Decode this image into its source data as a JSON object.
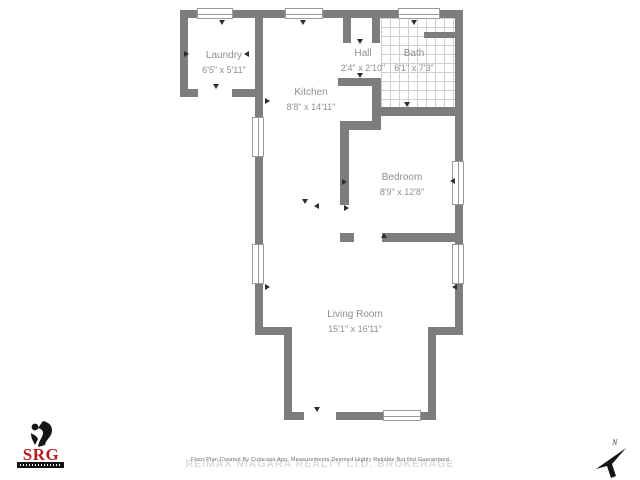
{
  "floorplan": {
    "wall_color": "#7d7d7d",
    "rooms": [
      {
        "name": "Laundry",
        "dims": "6'5\" x 5'11\"",
        "cx": 224,
        "cy": 63
      },
      {
        "name": "Hall",
        "dims": "2'4\" x 2'10\"",
        "cx": 363,
        "cy": 61
      },
      {
        "name": "Bath",
        "dims": "6'1\" x 7'3\"",
        "cx": 414,
        "cy": 61
      },
      {
        "name": "Kitchen",
        "dims": "8'8\" x 14'11\"",
        "cx": 311,
        "cy": 100
      },
      {
        "name": "Bedroom",
        "dims": "8'9\" x 12'8\"",
        "cx": 402,
        "cy": 185
      },
      {
        "name": "Living Room",
        "dims": "15'1\" x 16'11\"",
        "cx": 355,
        "cy": 322
      }
    ],
    "walls": [
      [
        180,
        10,
        283,
        8
      ],
      [
        180,
        10,
        8,
        87
      ],
      [
        180,
        89,
        18,
        8
      ],
      [
        232,
        89,
        31,
        8
      ],
      [
        255,
        18,
        8,
        79
      ],
      [
        255,
        97,
        8,
        20
      ],
      [
        255,
        157,
        8,
        87
      ],
      [
        255,
        284,
        8,
        51
      ],
      [
        255,
        327,
        37,
        8
      ],
      [
        284,
        327,
        8,
        93
      ],
      [
        284,
        412,
        20,
        8
      ],
      [
        336,
        412,
        48,
        8
      ],
      [
        421,
        412,
        15,
        8
      ],
      [
        428,
        335,
        8,
        85
      ],
      [
        428,
        327,
        35,
        8
      ],
      [
        455,
        18,
        8,
        143
      ],
      [
        455,
        205,
        8,
        39
      ],
      [
        455,
        284,
        8,
        51
      ],
      [
        343,
        18,
        8,
        25
      ],
      [
        372,
        18,
        8,
        25
      ],
      [
        338,
        78,
        43,
        8
      ],
      [
        372,
        78,
        9,
        52
      ],
      [
        381,
        107,
        82,
        9
      ],
      [
        340,
        121,
        41,
        9
      ],
      [
        340,
        130,
        9,
        75
      ],
      [
        340,
        233,
        14,
        9
      ],
      [
        382,
        233,
        81,
        9
      ],
      [
        424,
        32,
        31,
        6
      ]
    ],
    "windows": [
      [
        197,
        8,
        36,
        11,
        "h"
      ],
      [
        285,
        8,
        38,
        11,
        "h"
      ],
      [
        398,
        8,
        42,
        11,
        "h"
      ],
      [
        252,
        117,
        12,
        40,
        "v"
      ],
      [
        252,
        244,
        12,
        40,
        "v"
      ],
      [
        452,
        161,
        12,
        44,
        "v"
      ],
      [
        452,
        244,
        12,
        40,
        "v"
      ],
      [
        383,
        410,
        38,
        11,
        "h"
      ]
    ],
    "tiles": [
      381,
      18,
      74,
      89
    ],
    "markers": [
      {
        "x": 222,
        "y": 23,
        "dir": "down"
      },
      {
        "x": 303,
        "y": 23,
        "dir": "down"
      },
      {
        "x": 414,
        "y": 23,
        "dir": "down"
      },
      {
        "x": 187,
        "y": 54,
        "dir": "right"
      },
      {
        "x": 247,
        "y": 54,
        "dir": "left"
      },
      {
        "x": 216,
        "y": 87,
        "dir": "down"
      },
      {
        "x": 360,
        "y": 42,
        "dir": "down"
      },
      {
        "x": 360,
        "y": 76,
        "dir": "down"
      },
      {
        "x": 407,
        "y": 105,
        "dir": "down"
      },
      {
        "x": 268,
        "y": 101,
        "dir": "right"
      },
      {
        "x": 305,
        "y": 202,
        "dir": "down"
      },
      {
        "x": 317,
        "y": 206,
        "dir": "left"
      },
      {
        "x": 345,
        "y": 182,
        "dir": "right"
      },
      {
        "x": 453,
        "y": 181,
        "dir": "left"
      },
      {
        "x": 347,
        "y": 208,
        "dir": "right"
      },
      {
        "x": 384,
        "y": 236,
        "dir": "up"
      },
      {
        "x": 268,
        "y": 287,
        "dir": "right"
      },
      {
        "x": 455,
        "y": 287,
        "dir": "left"
      },
      {
        "x": 317,
        "y": 410,
        "dir": "down"
      }
    ]
  },
  "watermark": {
    "line_small": "Floor Plan Created By Cubicasa App. Measurements Deemed Highly Reliable But Not Guaranteed",
    "line_large": "RE/MAX NIAGARA REALTY LTD. BROKERAGE"
  },
  "logo": {
    "text": "SRG",
    "color": "#b51c22"
  },
  "compass": {
    "label": "N"
  }
}
